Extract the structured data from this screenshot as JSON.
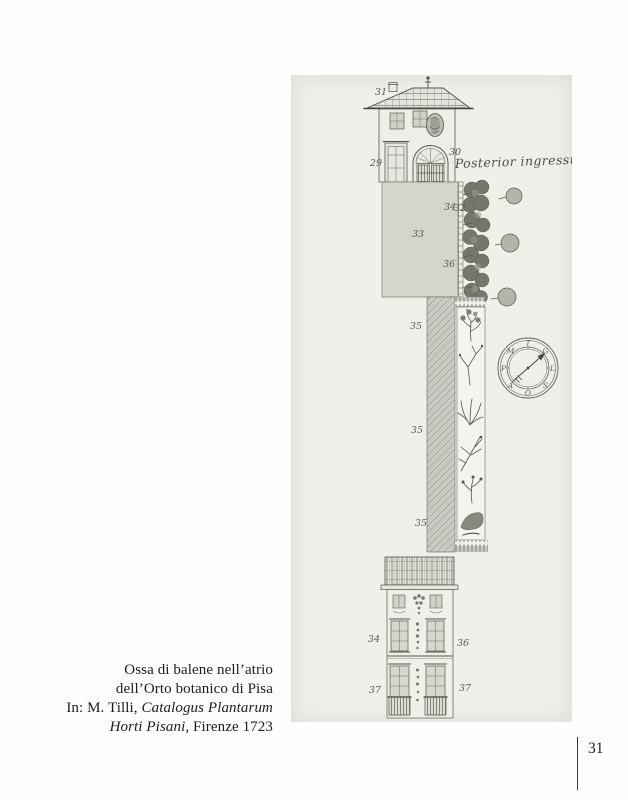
{
  "page_number": "31",
  "caption": {
    "line1": "Ossa di balene nell’atrio",
    "line2": "dell’Orto botanico di Pisa",
    "line3_prefix": "In: M. Tilli, ",
    "line3_italic": "Catalogus Plantarum",
    "line4_italic": "Horti Pisani",
    "line4_suffix": ", Firenze 1723"
  },
  "plate": {
    "inscription": "Posterior ingressus",
    "labels": {
      "chimney": "31",
      "left_door": "29",
      "gate": "30",
      "courtyard": "33",
      "tree_wall_a": "34",
      "tree_wall_b": "32",
      "tree_wall_c": "36",
      "long_wall_1": "35",
      "long_wall_2": "35",
      "long_wall_3": "35",
      "facade_upper_left": "34",
      "facade_upper_right": "36",
      "facade_lower_left": "37",
      "facade_lower_right": "37"
    },
    "compass": {
      "letters": [
        "T",
        "G",
        "L",
        "S",
        "O",
        "A",
        "P",
        "M"
      ]
    },
    "colors": {
      "plate_bg": "#eef0ea",
      "ink": "#4c4d45",
      "caption_text": "#1c1c1c"
    }
  }
}
